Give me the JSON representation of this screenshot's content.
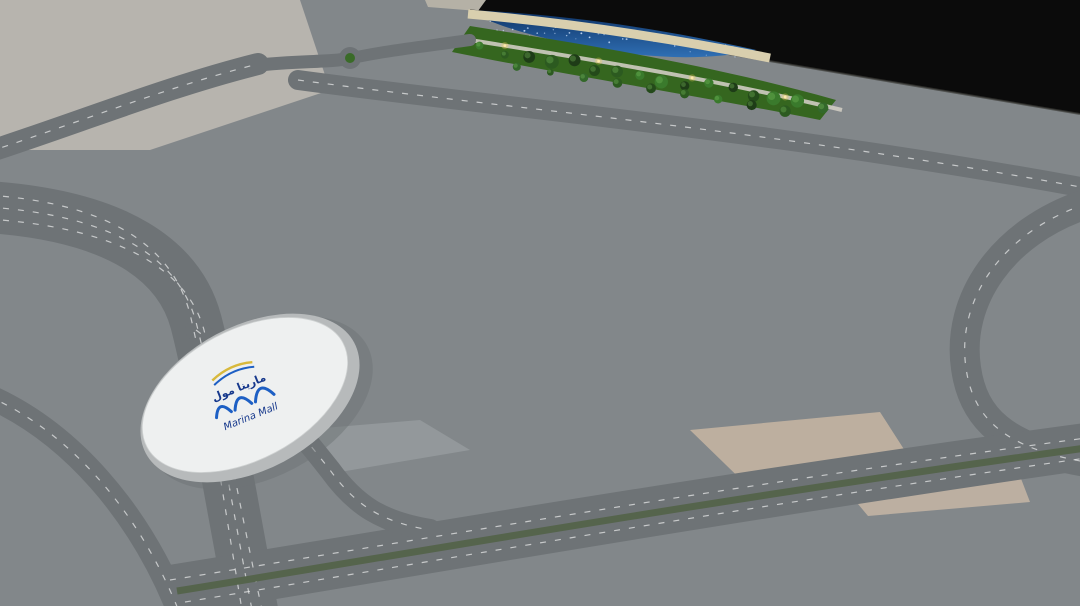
{
  "logo": {
    "arabic": "مارينا مول",
    "english": "Marina Mall"
  },
  "colors": {
    "backdrop": "#0b0b0b",
    "sea": "#16407e",
    "beach": "#d9cfae",
    "park": "#35661f",
    "road": "#6e7376",
    "platform": "#dfe2e2",
    "teal_glass": "#57c3d2",
    "skylight_glow": "#bfeef2",
    "tower_glass_left": "#2e6f74",
    "tower_glass_right": "#1e4f46",
    "cream_building": "#e9e5ba",
    "cream_roof": "#f1edc6",
    "logo_blue": "#1d5fc4",
    "logo_ribbon_yellow": "#d8b93c",
    "light_warm": "#ffd95e",
    "pool": "#2f7fd0",
    "flower_red": "#c0392b",
    "saucer_gray": "#d9dcdd",
    "antenna_red": "#e03224"
  },
  "car_palette": [
    "#f4f4f4",
    "#e6e6e6",
    "#c9ced1",
    "#23272a",
    "#3a3f44",
    "#8f979c",
    "#1c64c8",
    "#27408f",
    "#b03a2e",
    "#d4a017",
    "#caa93a"
  ],
  "tree_greens": [
    "#1e3c17",
    "#2c5a20",
    "#3a7a2c",
    "#244a1a",
    "#33682a"
  ]
}
